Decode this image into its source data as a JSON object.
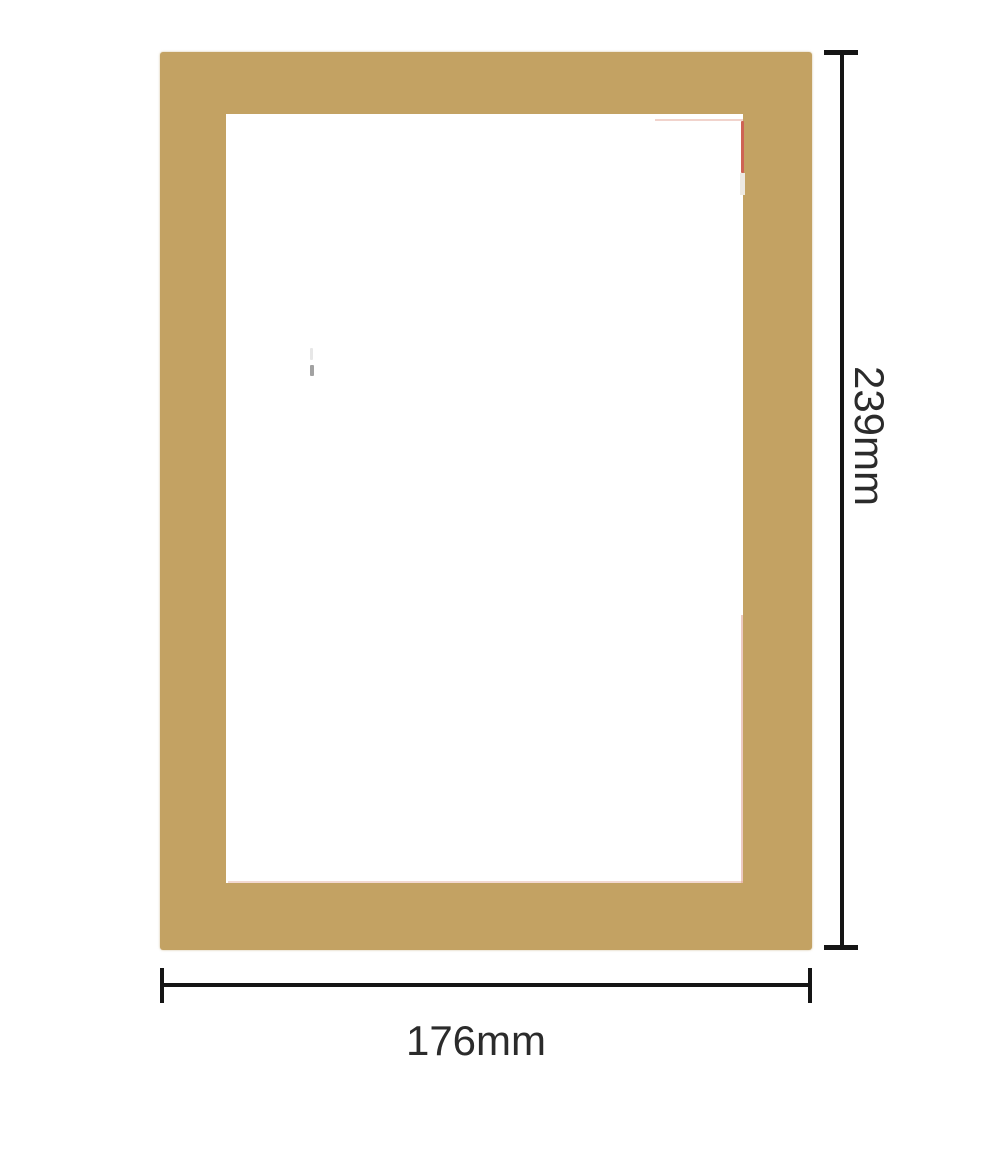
{
  "diagram": {
    "type": "product-dimension-diagram",
    "subject": "rectangular frame mat with window opening"
  },
  "dimensions": {
    "height": {
      "label": "239mm"
    },
    "width": {
      "label": "176mm"
    }
  },
  "colors": {
    "frame": "#C3A263",
    "accent-red": "#CE6354",
    "dim-line": "#151515",
    "label-text": "#2B2B2B",
    "background": "#FFFFFF"
  }
}
